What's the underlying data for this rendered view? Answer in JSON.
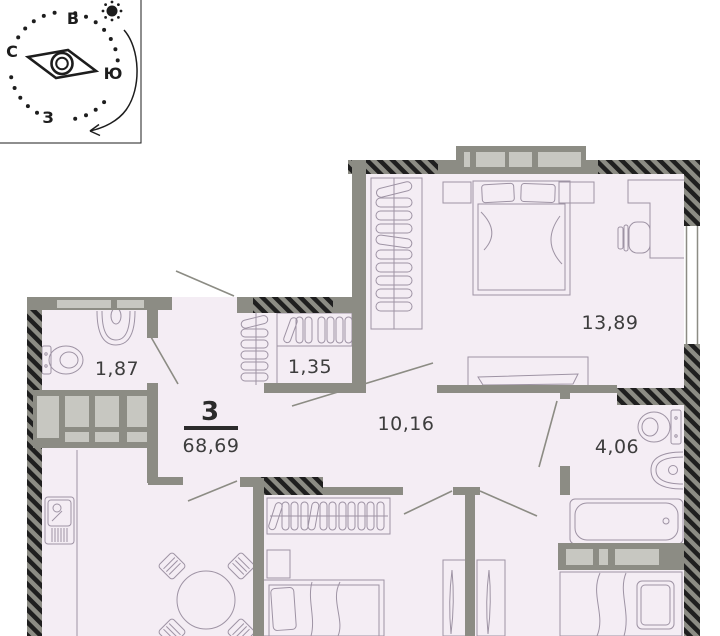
{
  "compass": {
    "letters": {
      "north": "С",
      "east": "В",
      "south": "Ю",
      "west": "З"
    }
  },
  "title_block": {
    "rooms_count": "3",
    "total_area": "68,69"
  },
  "rooms": {
    "wc": {
      "area": "1,87"
    },
    "closet": {
      "area": "1,35"
    },
    "bedroom": {
      "area": "13,89"
    },
    "hallway": {
      "area": "10,16"
    },
    "bathroom": {
      "area": "4,06"
    }
  },
  "icons": [
    "compass-rose",
    "sun-icon",
    "rotation-arrow-icon",
    "bed-icon",
    "wardrobe-hangers-icon",
    "toilet-icon",
    "washbasin-icon",
    "bathtub-icon",
    "dining-table-icon",
    "kitchen-sink-icon",
    "desk-icon",
    "desk-chair-icon",
    "chair-icon",
    "dresser-icon",
    "door-swing",
    "window",
    "vent-shaft"
  ],
  "colors": {
    "floor": "#f4edf4",
    "wall": "#8c8c84",
    "wall_light_inset": "#c7c7c1",
    "hatch": "#1f1f1f",
    "furniture_line": "#9e93a4",
    "label_text": "#3d3d3d"
  }
}
